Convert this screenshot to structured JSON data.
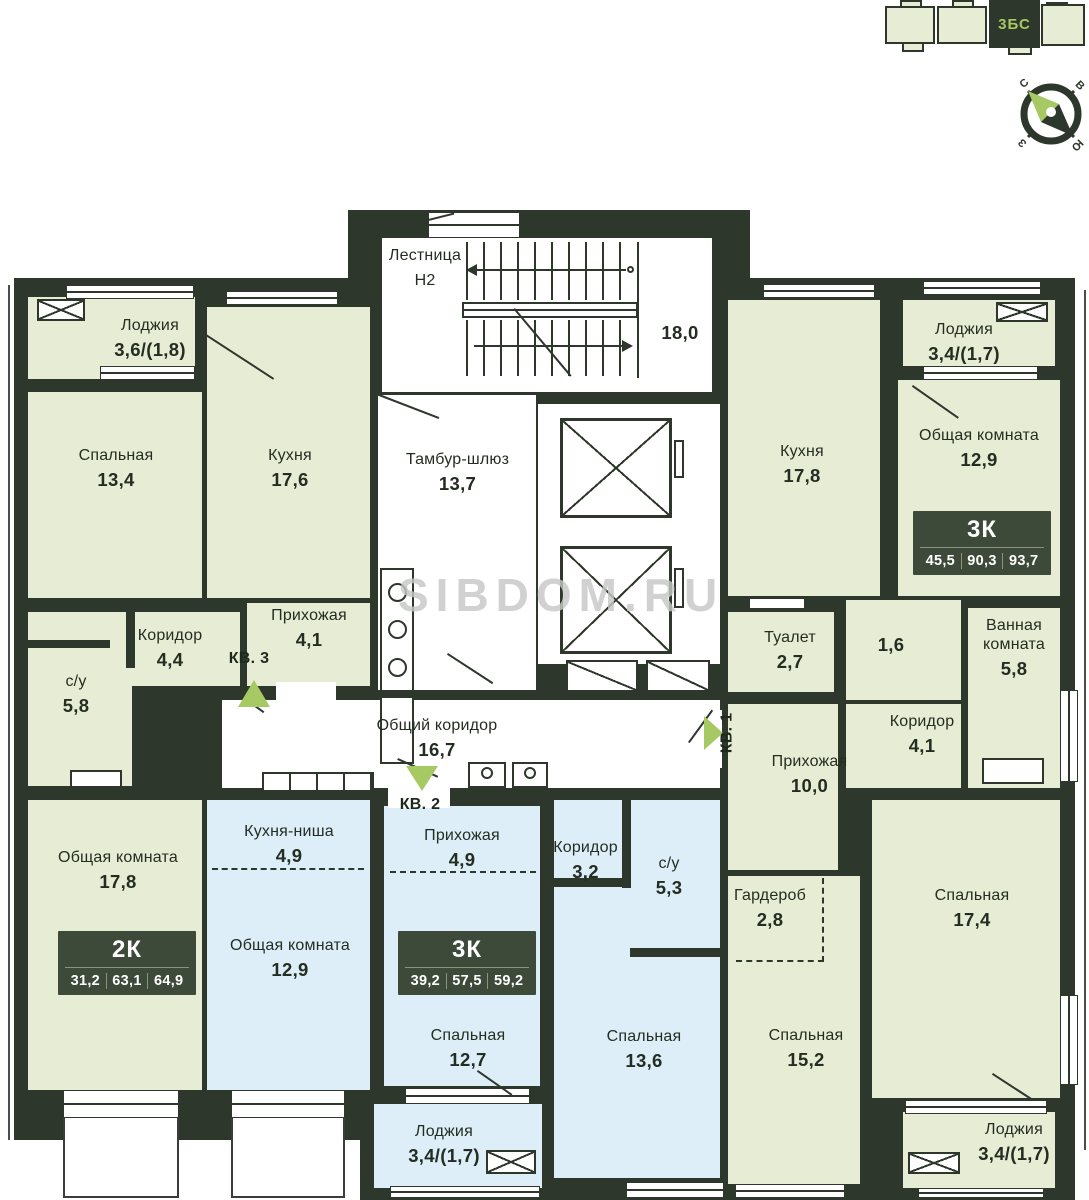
{
  "watermark": "SIBDOM.RU",
  "locator": {
    "section_label": "3БС"
  },
  "compass": {
    "north": "С",
    "east": "В",
    "west": "З",
    "south": "Ю"
  },
  "common_areas": {
    "staircase": {
      "name": "Лестница",
      "code": "Н2",
      "area": "18,0"
    },
    "vestibule": {
      "name": "Тамбур-шлюз",
      "area": "13,7"
    },
    "corridor": {
      "name": "Общий коридор",
      "area": "16,7"
    }
  },
  "apartments": {
    "kv1": {
      "marker": "КВ. 1",
      "badge": {
        "type": "3К",
        "values": [
          "45,5",
          "90,3",
          "93,7"
        ]
      },
      "rooms": {
        "kitchen": {
          "name": "Кухня",
          "area": "17,8"
        },
        "loggia_top": {
          "name": "Лоджия",
          "area": "3,4/(1,7)"
        },
        "living": {
          "name": "Общая комната",
          "area": "12,9"
        },
        "toilet": {
          "name": "Туалет",
          "area": "2,7"
        },
        "niche": {
          "area": "1,6"
        },
        "bathroom": {
          "name": "Ванная комната",
          "area": "5,8"
        },
        "corridor": {
          "name": "Коридор",
          "area": "4,1"
        },
        "hallway": {
          "name": "Прихожая",
          "area": "10,0"
        },
        "wardrobe": {
          "name": "Гардероб",
          "area": "2,8"
        },
        "bedroom_right": {
          "name": "Спальная",
          "area": "17,4"
        },
        "bedroom_left": {
          "name": "Спальная",
          "area": "15,2"
        },
        "loggia_bottom": {
          "name": "Лоджия",
          "area": "3,4/(1,7)"
        }
      }
    },
    "kv2": {
      "marker": "КВ. 2",
      "badge": {
        "type": "3К",
        "values": [
          "39,2",
          "57,5",
          "59,2"
        ]
      },
      "rooms": {
        "kitchen_niche": {
          "name": "Кухня-ниша",
          "area": "4,9"
        },
        "living": {
          "name": "Общая комната",
          "area": "12,9"
        },
        "hallway": {
          "name": "Прихожая",
          "area": "4,9"
        },
        "corridor": {
          "name": "Коридор",
          "area": "3,2"
        },
        "wc": {
          "name": "с/у",
          "area": "5,3"
        },
        "bedroom_left": {
          "name": "Спальная",
          "area": "12,7"
        },
        "bedroom_right": {
          "name": "Спальная",
          "area": "13,6"
        },
        "loggia": {
          "name": "Лоджия",
          "area": "3,4/(1,7)"
        }
      }
    },
    "kv3": {
      "marker": "КВ. 3",
      "badge": {
        "type": "2К",
        "values": [
          "31,2",
          "63,1",
          "64,9"
        ]
      },
      "rooms": {
        "loggia": {
          "name": "Лоджия",
          "area": "3,6/(1,8)"
        },
        "bedroom": {
          "name": "Спальная",
          "area": "13,4"
        },
        "kitchen": {
          "name": "Кухня",
          "area": "17,6"
        },
        "corridor": {
          "name": "Коридор",
          "area": "4,4"
        },
        "hallway": {
          "name": "Прихожая",
          "area": "4,1"
        },
        "wc": {
          "name": "с/у",
          "area": "5,8"
        },
        "living": {
          "name": "Общая комната",
          "area": "17,8"
        }
      }
    }
  },
  "colors": {
    "wall": "#2d372c",
    "room_green": "#e7edd4",
    "room_blue": "#ddeef8",
    "accent_green": "#a6c964",
    "badge_bg": "#3d4a3a"
  }
}
